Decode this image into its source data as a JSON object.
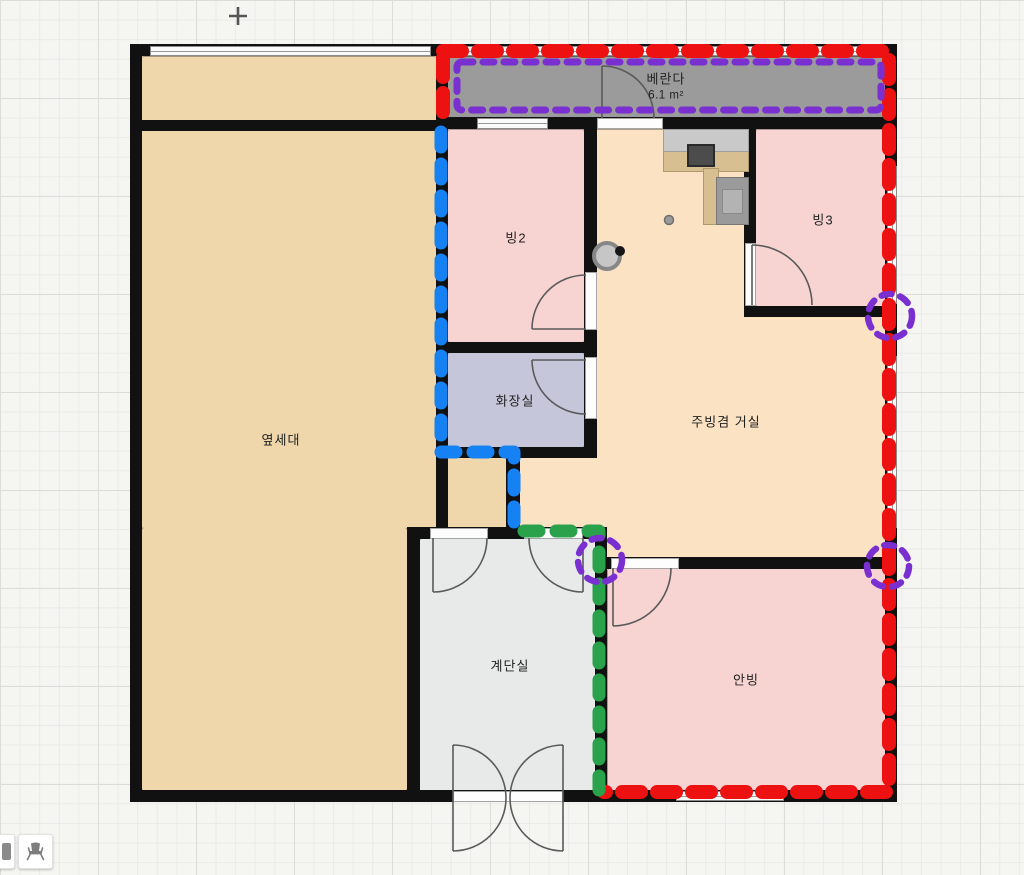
{
  "canvas": {
    "crosshair_symbol": "+",
    "grid_visible": true
  },
  "rooms": {
    "veranda": {
      "name": "베란다",
      "area": "6.1 m²",
      "fill": "#9b9b9b"
    },
    "room2": {
      "name": "빙2",
      "fill": "#f7d4d2"
    },
    "room3": {
      "name": "빙3",
      "fill": "#f7d4d2"
    },
    "neighbor_unit": {
      "name": "옆세대",
      "fill": "#efd7ab"
    },
    "bathroom": {
      "name": "화장실",
      "fill": "#c5c6d9"
    },
    "kitchen_living": {
      "name": "주빙겸 거실",
      "fill": "#fae2c2"
    },
    "stairwell": {
      "name": "계단실",
      "fill": "#e7eae8"
    },
    "master_room": {
      "name": "안빙",
      "fill": "#f7d4d2"
    }
  },
  "overlay_colors": {
    "red": "#ee1111",
    "blue": "#1581f2",
    "green": "#2aa24b",
    "purple": "#7a2fd0"
  },
  "structure_colors": {
    "wall": "#111111",
    "counter": "#c9c9c9",
    "cabinet_wood": "#d8bf92"
  },
  "toolbar": {
    "buttons": [
      {
        "icon": "wall-segment-icon"
      },
      {
        "icon": "chair-icon"
      }
    ]
  }
}
